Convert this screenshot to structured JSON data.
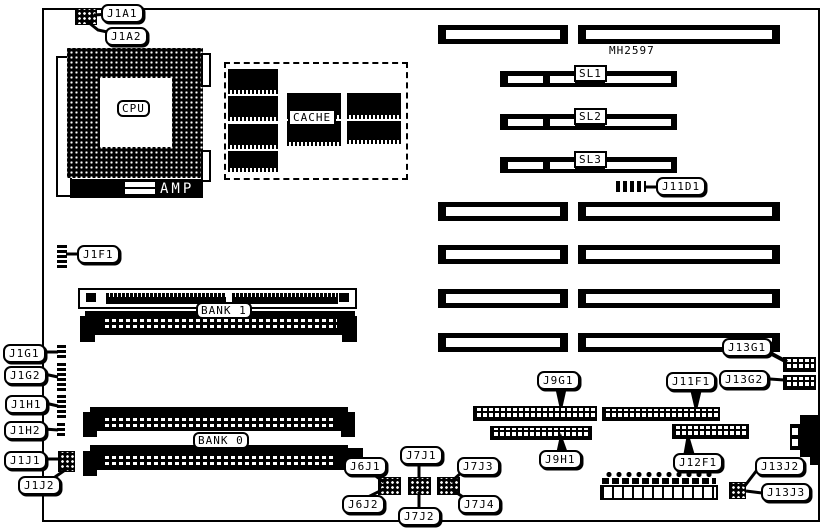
{
  "figure": {
    "model_number": "MH2597"
  },
  "components": {
    "cpu": "CPU",
    "cache": "CACHE",
    "amp": "AMP",
    "bank0": "BANK 0",
    "bank1": "BANK 1",
    "sl1": "SL1",
    "sl2": "SL2",
    "sl3": "SL3"
  },
  "labels": {
    "j1a1": "J1A1",
    "j1a2": "J1A2",
    "j1f1": "J1F1",
    "j1g1": "J1G1",
    "j1g2": "J1G2",
    "j1h1": "J1H1",
    "j1h2": "J1H2",
    "j1j1": "J1J1",
    "j1j2": "J1J2",
    "j6j1": "J6J1",
    "j6j2": "J6J2",
    "j7j1": "J7J1",
    "j7j2": "J7J2",
    "j7j3": "J7J3",
    "j7j4": "J7J4",
    "j9g1": "J9G1",
    "j9h1": "J9H1",
    "j11d1": "J11D1",
    "j11f1": "J11F1",
    "j12f1": "J12F1",
    "j13g1": "J13G1",
    "j13g2": "J13G2",
    "j13j2": "J13J2",
    "j13j3": "J13J3"
  }
}
